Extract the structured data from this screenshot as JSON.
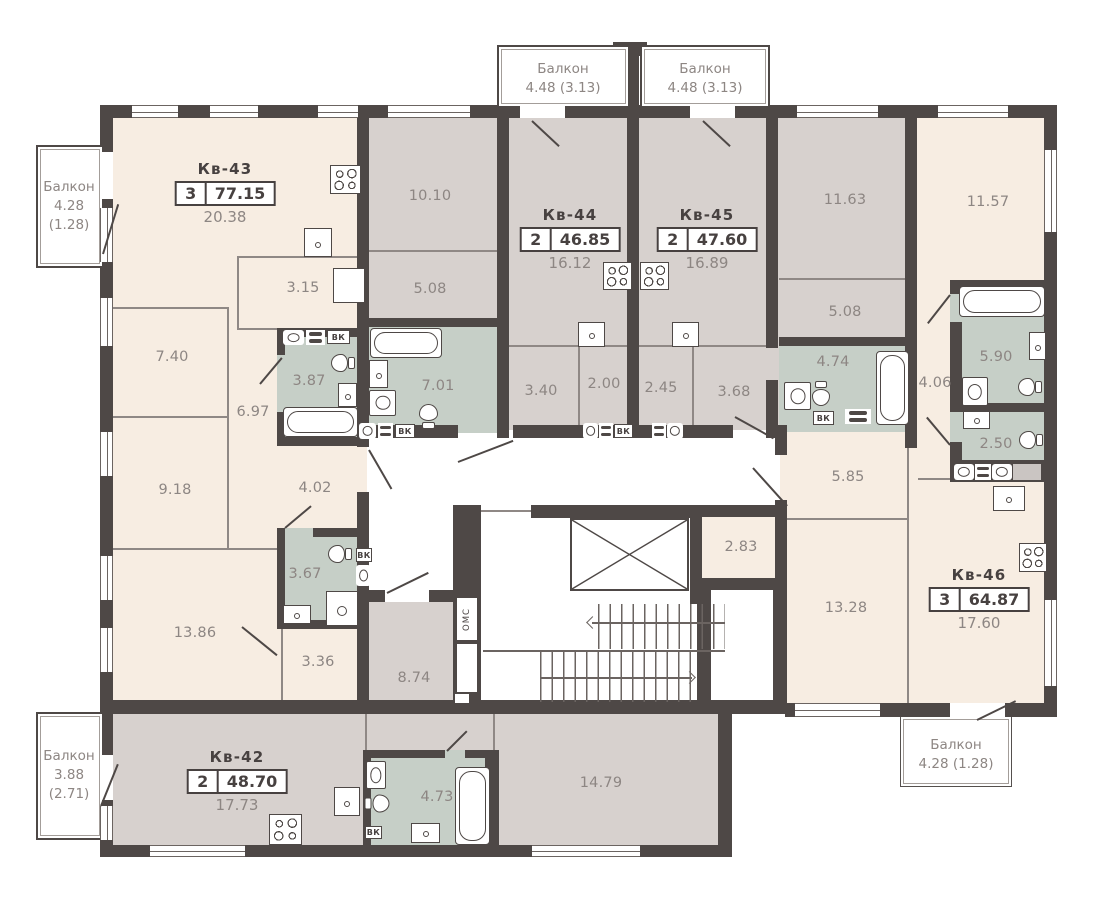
{
  "apartments": {
    "kv42": {
      "name": "Кв-42",
      "rooms": "2",
      "total": "48.70",
      "main_area": "17.73"
    },
    "kv43": {
      "name": "Кв-43",
      "rooms": "3",
      "total": "77.15",
      "main_area": "20.38"
    },
    "kv44": {
      "name": "Кв-44",
      "rooms": "2",
      "total": "46.85",
      "main_area": "16.12"
    },
    "kv45": {
      "name": "Кв-45",
      "rooms": "2",
      "total": "47.60",
      "main_area": "16.89"
    },
    "kv46": {
      "name": "Кв-46",
      "rooms": "3",
      "total": "64.87",
      "main_area": "17.60"
    }
  },
  "areas": {
    "kv43_closet": "3.15",
    "kv43_room_a": "7.40",
    "kv43_bath": "3.87",
    "kv43_hall_a": "6.97",
    "kv43_room_b": "9.18",
    "kv43_hall_b": "4.02",
    "kv43_wc": "3.67",
    "kv43_room_c": "13.86",
    "kv43_hall_c": "3.36",
    "kv44_room_a": "10.10",
    "kv44_room_b": "5.08",
    "kv44_bath": "7.01",
    "kv44_hall_a": "3.40",
    "kv44_hall_b": "2.00",
    "kv45_hall_a": "2.45",
    "kv45_hall_b": "3.68",
    "kv45_room_a": "11.63",
    "kv45_room_b": "5.08",
    "kv45_bath": "4.74",
    "kv46_room_a": "11.57",
    "kv46_bath": "5.90",
    "kv46_hall_a": "4.06",
    "kv46_wc": "2.50",
    "kv46_hall_b": "5.85",
    "kv46_pantry": "2.83",
    "kv46_room_b": "13.28",
    "kv42_hall": "8.74",
    "kv42_bath": "4.73",
    "kv42_room": "14.79"
  },
  "balconies": {
    "top_left": {
      "name": "Балкон",
      "area": "4.48 (3.13)"
    },
    "top_right": {
      "name": "Балкон",
      "area": "4.48 (3.13)"
    },
    "left": {
      "name": "Балкон",
      "area_line1": "4.28",
      "area_line2": "(1.28)"
    },
    "bottom_left": {
      "name": "Балкон",
      "area_line1": "3.88",
      "area_line2": "(2.71)"
    },
    "bottom_right": {
      "name": "Балкон",
      "area": "4.28 (1.28)"
    }
  },
  "annotations": {
    "vk": "ВК",
    "oms": "ОМС"
  },
  "colors": {
    "wall": "#4e4846",
    "room_warm": "#f7ede2",
    "room_gray": "#d7d1ce",
    "room_wet": "#c6cfc7",
    "label": "#8d8683",
    "text_dark": "#474140"
  }
}
